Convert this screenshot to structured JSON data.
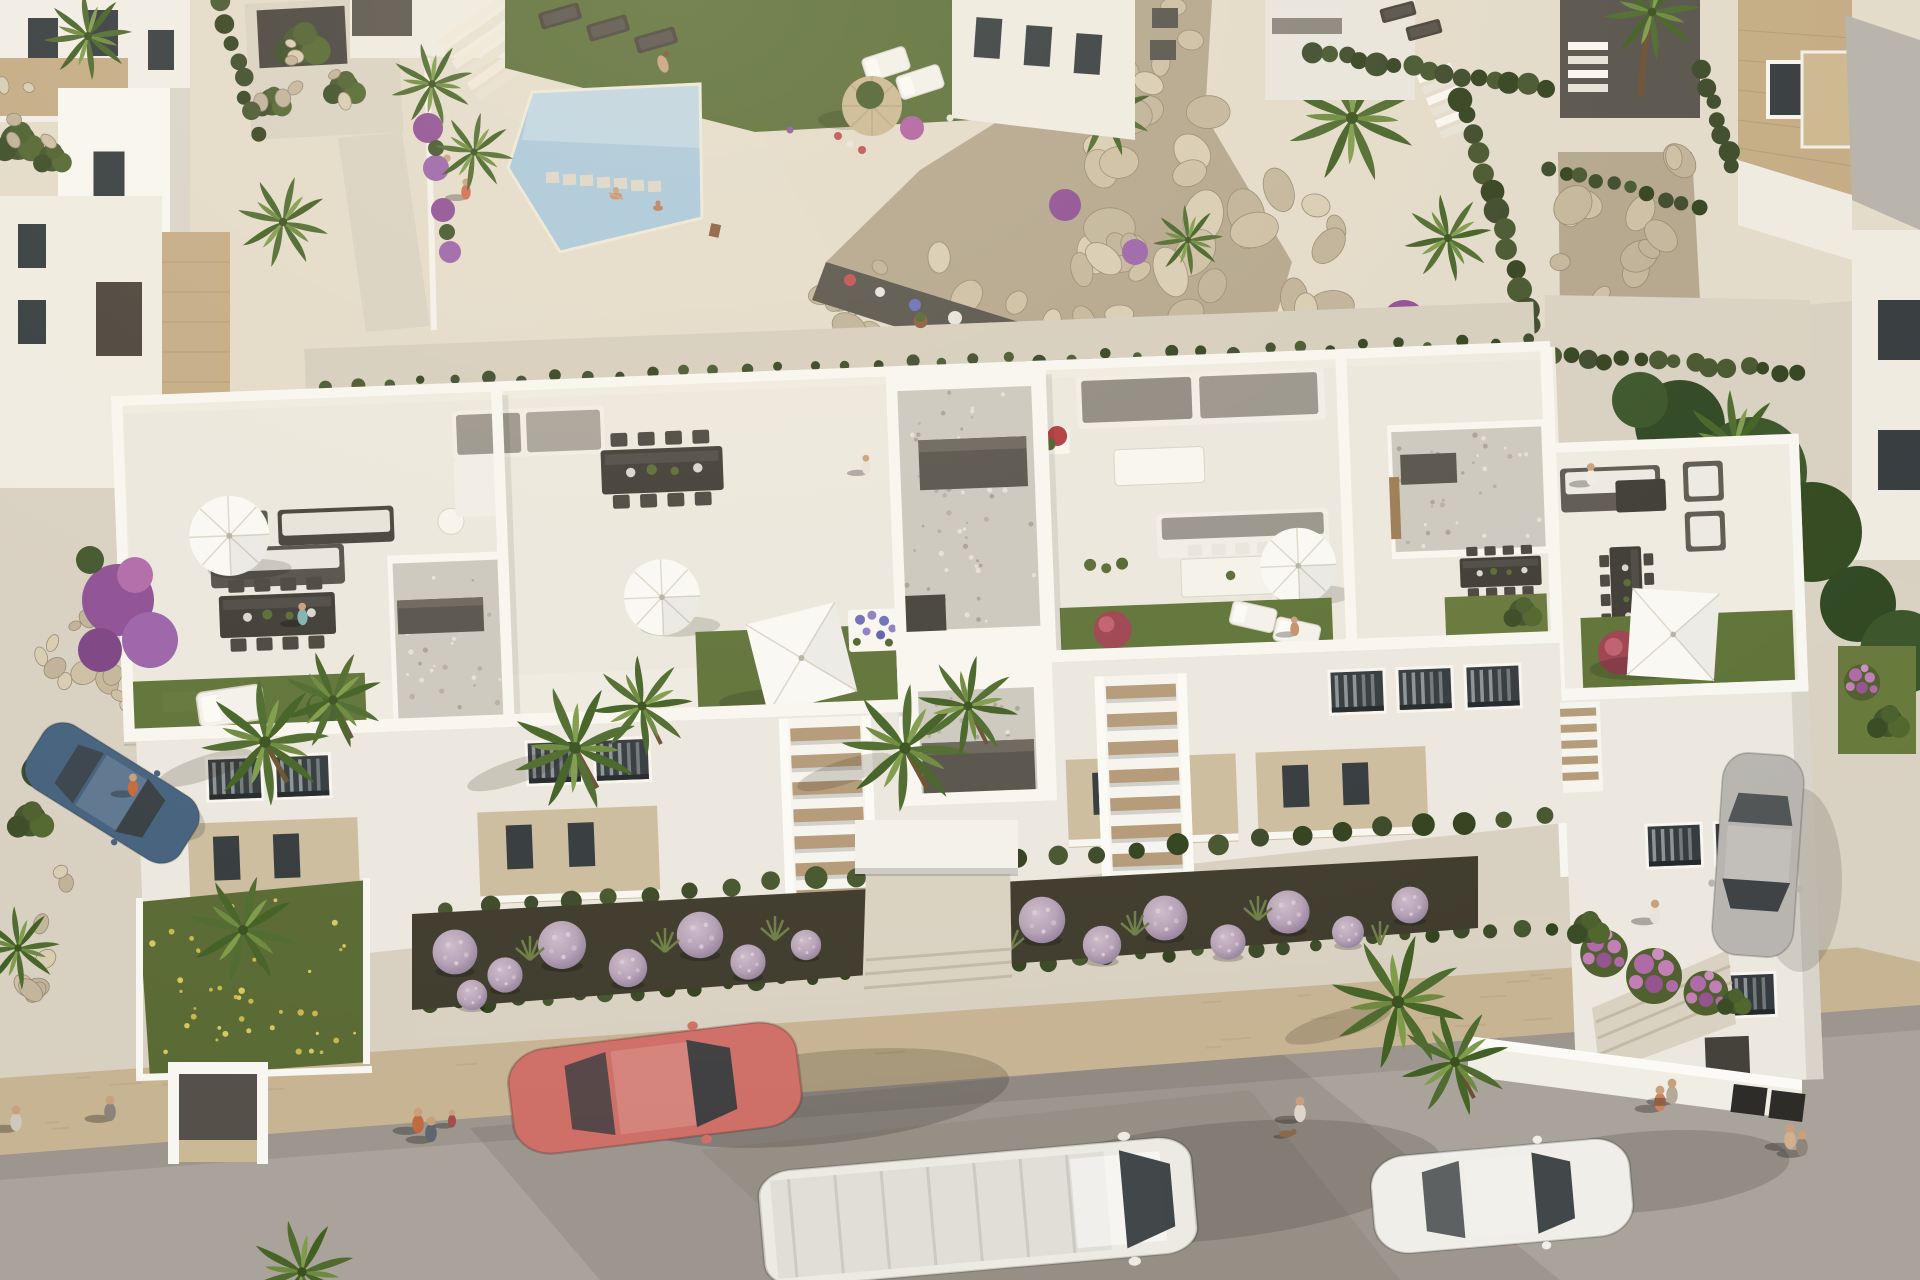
{
  "scene": {
    "type": "aerial-3d-architectural-render",
    "subject": "Modern white apartment complex with rooftop terraces, communal pool, gardens and street frontage",
    "lighting": "warm golden-hour sunlight",
    "visible_text": "none"
  },
  "palette": {
    "paving": "#d8d0c1",
    "paving_warm": "#e3dbc9",
    "street": "#aaa39b",
    "sidewalk_wall": "#c7b493",
    "walkway": "#d9d2c2",
    "soil": "#3f3b2d",
    "lawn": "#5f7338",
    "lawn_wild": "#5a6a34",
    "hedge": "#3c4a2a",
    "building_white": "#efebe1",
    "terrace_floor": "#e9e5db",
    "building_shade": "#d9d4ca",
    "pool_water": "#aac8da",
    "rock_base": "#b3a68c",
    "rock_light": "#d8ccb2",
    "travertine": "#c4ab84",
    "roof_gray": "#b7b3ab",
    "gravel": "#ccc8bf",
    "furniture_dark": "#57534b",
    "wood": "#b49a78",
    "parasol": "#f9f8f3",
    "parasol_tan": "#cbb894",
    "lavender": "#b5a2b6",
    "bougainvillea": "#8e4f93",
    "flower_red": "#c0504e",
    "palm_green": "#5d7b35",
    "skin": "#c9a07b"
  },
  "buildings": {
    "main": {
      "label": "three-storey apartment block with rooftop terraces",
      "features": [
        "rooftop lawns",
        "round and square white parasols",
        "outdoor lounge sets",
        "dining sets",
        "gravel-roof stair towers",
        "recessed balconies",
        "external wooden staircases"
      ]
    },
    "left_villas": {
      "label": "neighbouring white villas with travertine accents"
    },
    "upper_apartment": {
      "label": "apartment building behind the pool"
    },
    "stone_villa": {
      "label": "travertine villa with chimney and grey roof"
    },
    "right_wing": {
      "label": "right wing block with roof terrace and lounge"
    }
  },
  "amenities": {
    "pool": {
      "label": "communal swimming pool with stepping stones"
    },
    "pool_lawn": {
      "label": "sunbathing lawn with dark loungers and tan parasol"
    },
    "rock_garden": {
      "label": "boulder rockery slope with palms"
    },
    "street": {
      "label": "asphalt street with parked and passing cars"
    },
    "sidewalk": {
      "label": "travertine boundary wall with clipped hedge and walkway"
    },
    "front_garden": {
      "label": "ornamental beds with lavender balls, grasses and palms"
    }
  },
  "vehicles": [
    {
      "name": "red-coupe",
      "color": "#cf7068"
    },
    {
      "name": "white-van",
      "color": "#edeae3"
    },
    {
      "name": "white-sedan",
      "color": "#f0eee8"
    },
    {
      "name": "silver-car",
      "color": "#b8b5b0"
    },
    {
      "name": "blue-hatchback",
      "color": "#44617d"
    }
  ],
  "people": [
    {
      "role": "pool-sunbather",
      "color": "#c9a07b"
    },
    {
      "role": "pool-swimmer",
      "color": "#c98e6a"
    },
    {
      "role": "pool-swimmer-2",
      "color": "#b5805e"
    },
    {
      "role": "pool-deck-walker",
      "color": "#e2dacb"
    },
    {
      "role": "pool-deck-walker-2",
      "color": "#d06a54"
    },
    {
      "role": "terrace-woman-stretching",
      "color": "#7fb3b0"
    },
    {
      "role": "terrace-lounger-sitter",
      "color": "#e8e2d6"
    },
    {
      "role": "terrace-walker-right-wing",
      "color": "#f0ece2"
    },
    {
      "role": "terrace-lawn-person",
      "color": "#c98e6a"
    },
    {
      "role": "carpark-person-blue-car",
      "color": "#c26a3a"
    },
    {
      "role": "street-walker-far-left",
      "color": "#cfc8bd"
    },
    {
      "role": "street-walker-by-gate",
      "color": "#8c8379"
    },
    {
      "role": "street-family-adult",
      "color": "#c1693f"
    },
    {
      "role": "street-family-adult-2",
      "color": "#5f6670"
    },
    {
      "role": "street-family-child",
      "color": "#a34d4d"
    },
    {
      "role": "street-dog-walker",
      "color": "#ddd6c9"
    },
    {
      "role": "street-couple-a",
      "color": "#c8845f"
    },
    {
      "role": "street-couple-b",
      "color": "#b5aa9a"
    },
    {
      "role": "sidewalk-person-right",
      "color": "#e8e4da"
    },
    {
      "role": "street-couple-right-a",
      "color": "#d3b08c"
    },
    {
      "role": "street-couple-right-b",
      "color": "#8f8578"
    }
  ],
  "vegetation": {
    "palms": 20,
    "lavender_balls": 16,
    "purple_bougainvillea": 4,
    "hedges": "clipped hedges along walls and paths",
    "lawns": 6
  }
}
